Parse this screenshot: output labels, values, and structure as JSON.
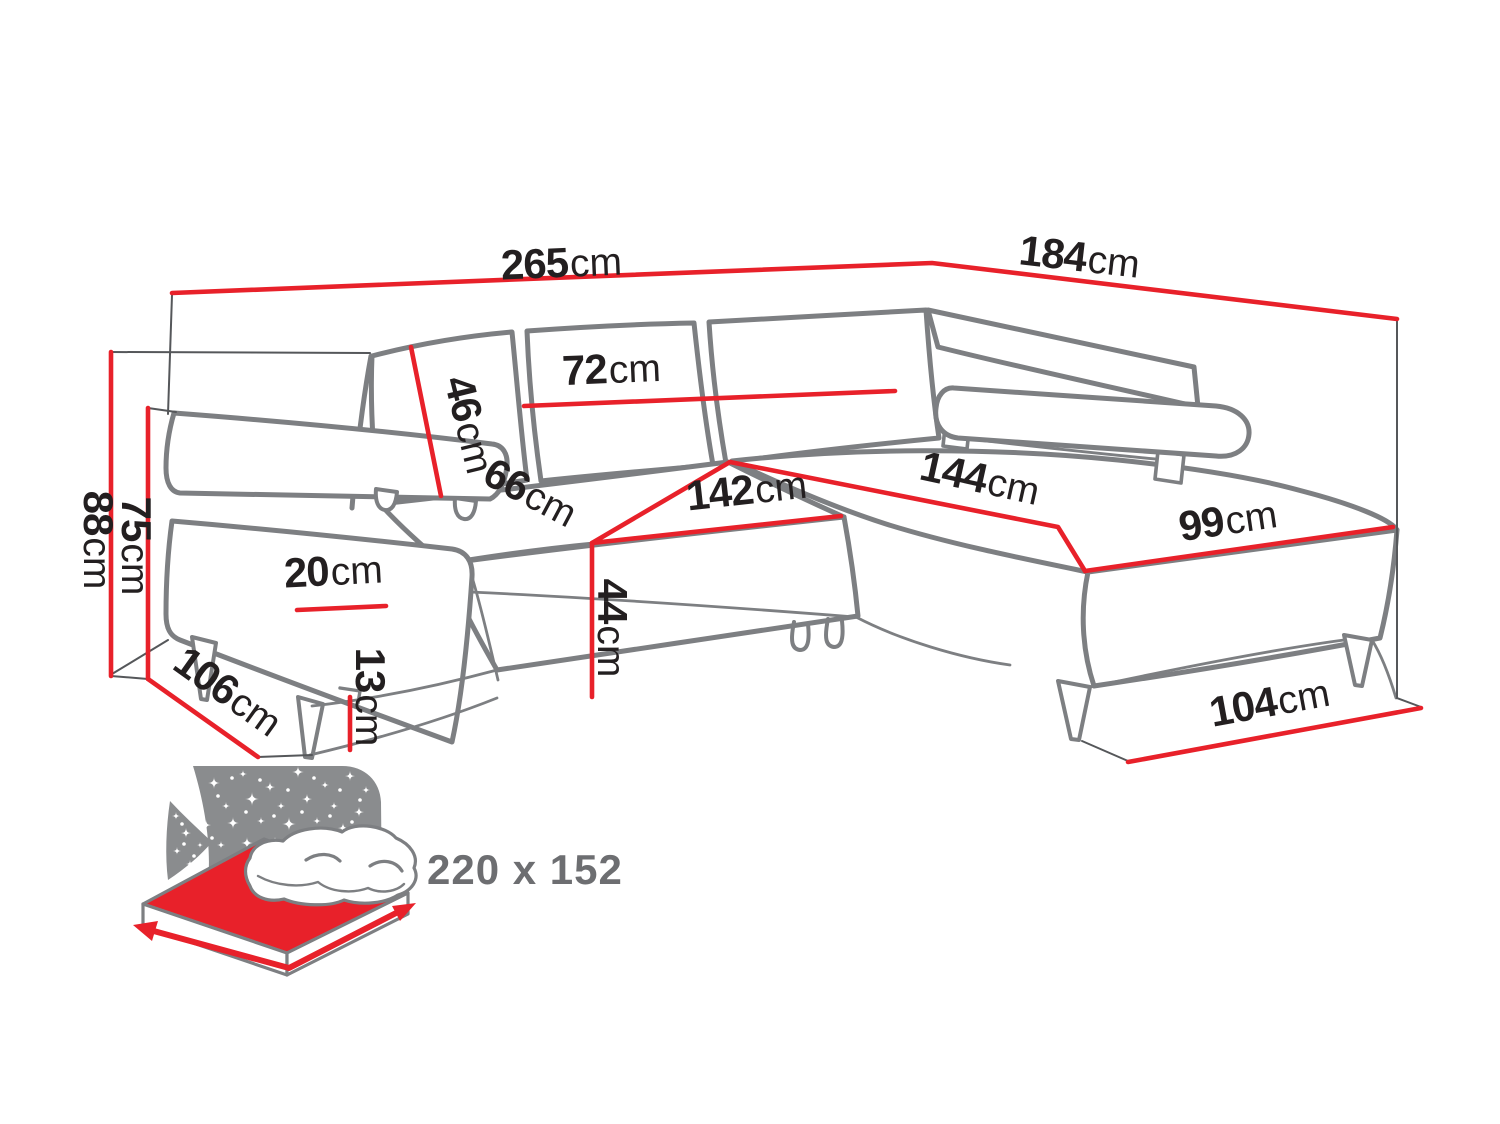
{
  "colors": {
    "dimension_red": "#e8212a",
    "outline_gray": "#7d7f82",
    "label_black": "#231f20",
    "icon_gray": "#8a8c8e",
    "icon_text_gray": "#6d6e71",
    "background": "#ffffff"
  },
  "diagram": {
    "subject": "corner-sofa-with-dimensions",
    "dimensions": [
      {
        "name": "overall-width",
        "value": "265",
        "unit": "cm"
      },
      {
        "name": "overall-depth",
        "value": "184",
        "unit": "cm"
      },
      {
        "name": "overall-height",
        "value": "88",
        "unit": "cm"
      },
      {
        "name": "backrest-height",
        "value": "75",
        "unit": "cm"
      },
      {
        "name": "back-cushion-height",
        "value": "46",
        "unit": "cm"
      },
      {
        "name": "back-cushion-width",
        "value": "72",
        "unit": "cm"
      },
      {
        "name": "seat-depth",
        "value": "66",
        "unit": "cm"
      },
      {
        "name": "seat-width",
        "value": "142",
        "unit": "cm"
      },
      {
        "name": "armrest-width",
        "value": "20",
        "unit": "cm"
      },
      {
        "name": "seat-height",
        "value": "44",
        "unit": "cm"
      },
      {
        "name": "leg-height",
        "value": "13",
        "unit": "cm"
      },
      {
        "name": "side-depth",
        "value": "106",
        "unit": "cm"
      },
      {
        "name": "chaise-length",
        "value": "144",
        "unit": "cm"
      },
      {
        "name": "chaise-width",
        "value": "99",
        "unit": "cm"
      },
      {
        "name": "chaise-front-width",
        "value": "104",
        "unit": "cm"
      }
    ],
    "sleeping_area": {
      "icon": "sleeping-surface-icon",
      "value": "220 x 152"
    }
  }
}
